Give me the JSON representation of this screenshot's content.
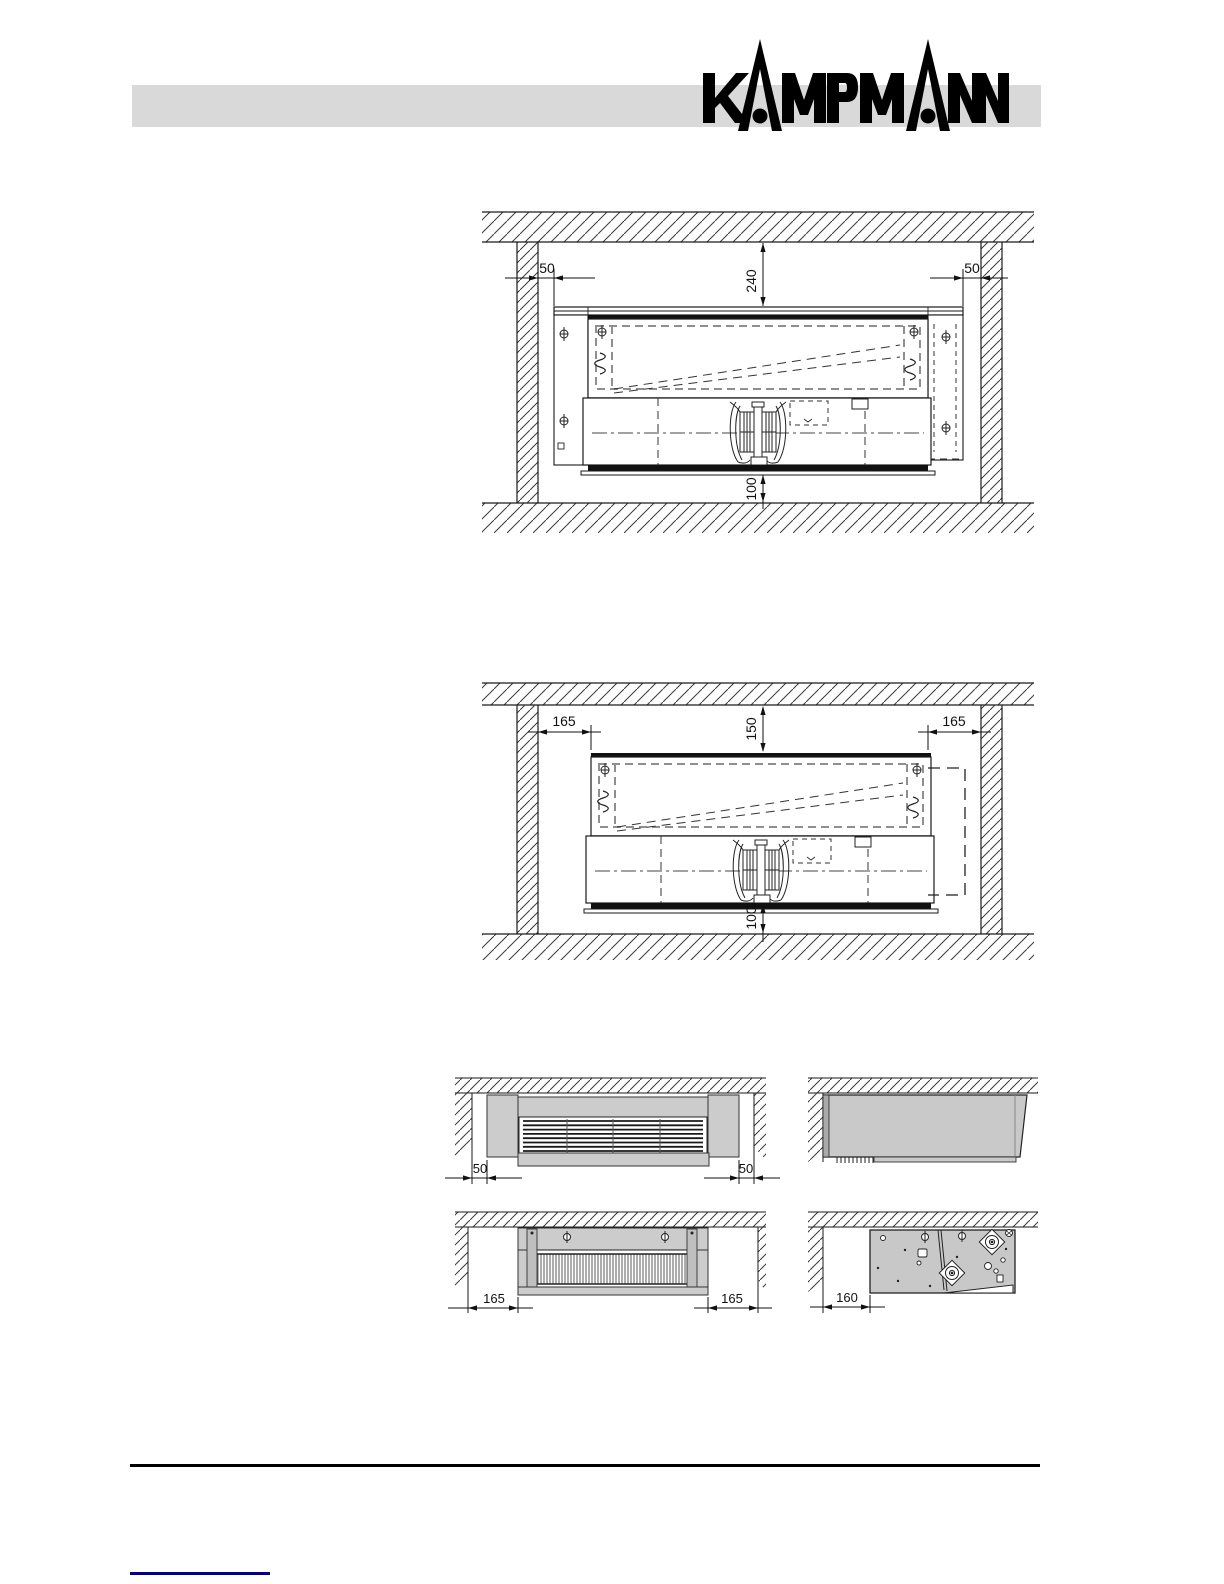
{
  "brand": {
    "name": "KAMPMANN"
  },
  "drawings": {
    "recess_50": {
      "gap_left": "50",
      "gap_right": "50",
      "clearance_top": "240",
      "clearance_bottom": "100"
    },
    "recess_165": {
      "gap_left": "165",
      "gap_right": "165",
      "clearance_top": "150",
      "clearance_bottom": "100"
    },
    "front_50": {
      "gap_left": "50",
      "gap_right": "50"
    },
    "front_165": {
      "gap_left": "165",
      "gap_right": "165"
    },
    "side_160": {
      "gap_left": "160"
    }
  },
  "colors": {
    "header_bar": "#d9d9d9",
    "logo": "#000000",
    "panel_gray": "#cccccc",
    "drawing_line": "#1a1a1a",
    "footer_rule": "#000000",
    "footer_link_rule": "#00008b"
  }
}
